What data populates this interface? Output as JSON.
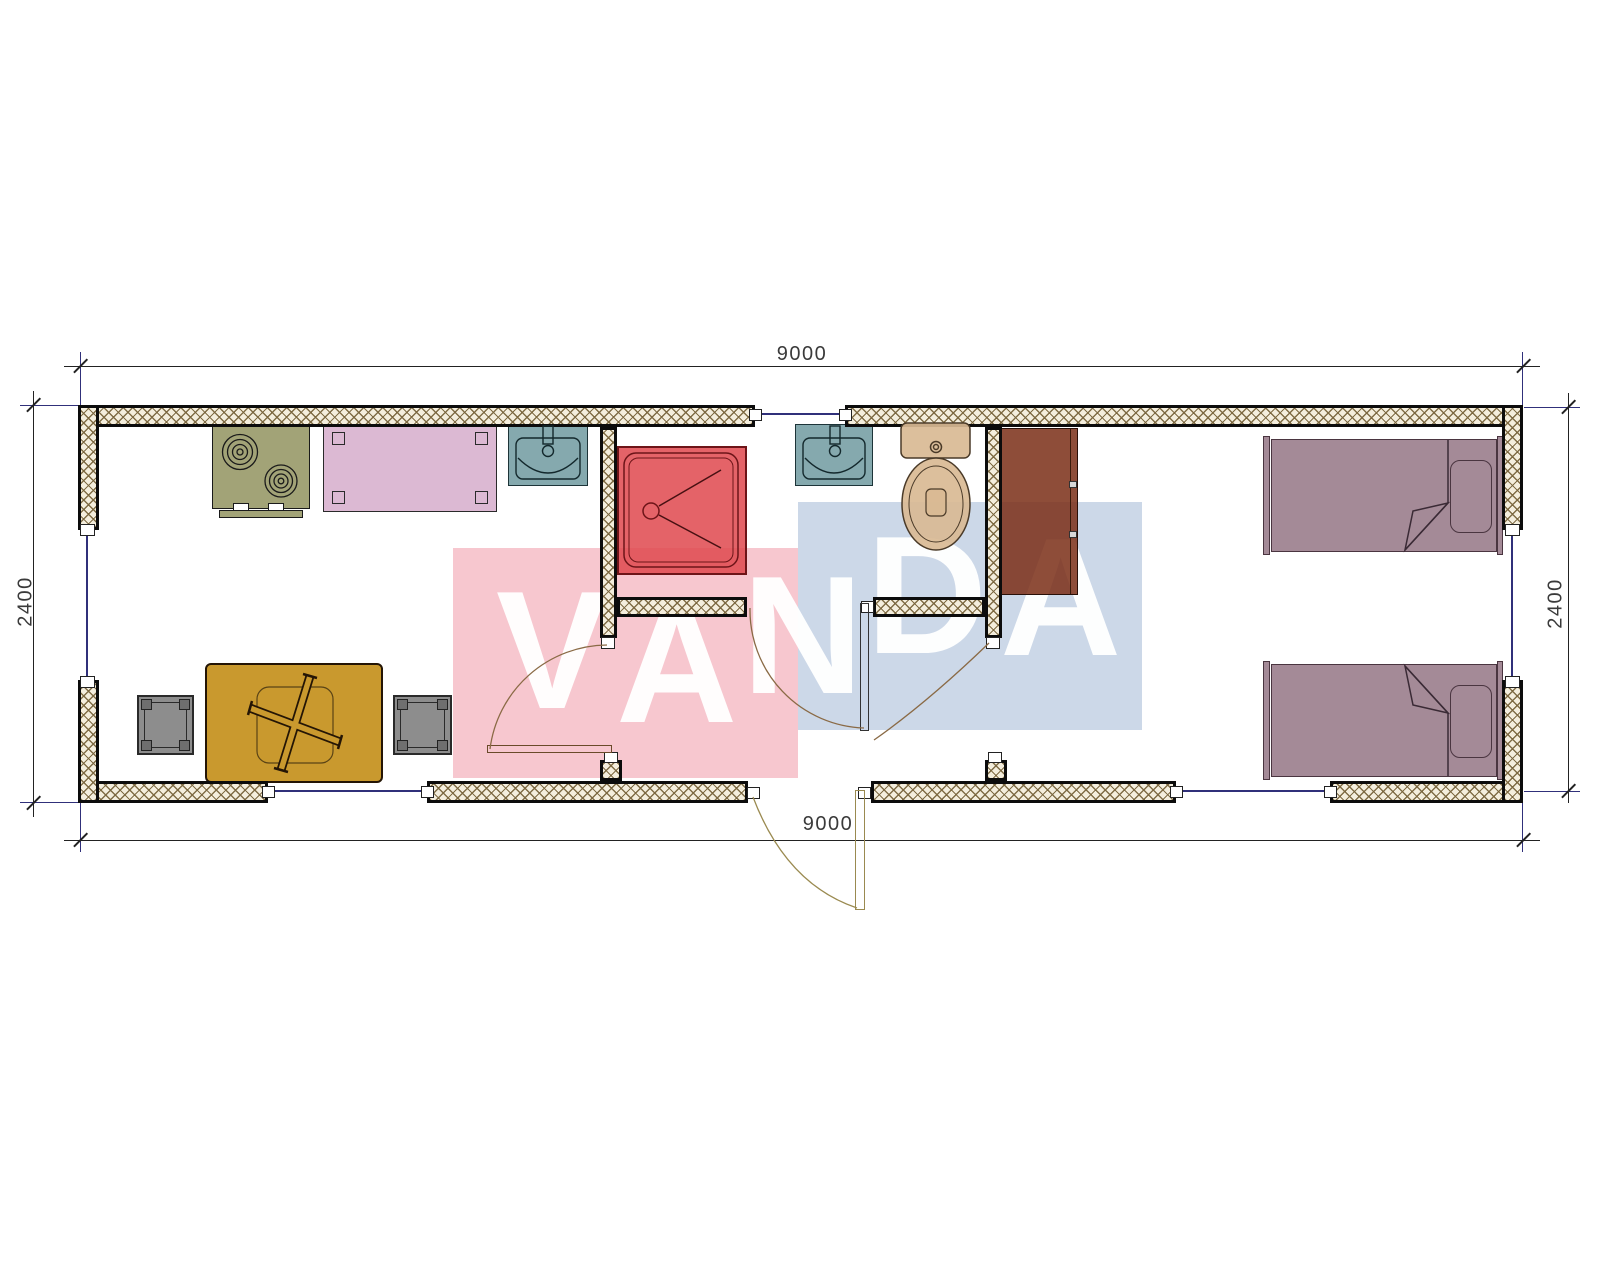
{
  "drawing": {
    "type": "floor-plan",
    "dimensions": {
      "top": "9000",
      "bottom": "9000",
      "left": "2400",
      "right": "2400"
    },
    "watermark": {
      "text": "VANDA",
      "letters": [
        "V",
        "A",
        "N",
        "D",
        "A"
      ]
    },
    "palette": {
      "wall_fill": "#f4eedd",
      "wall_line": "#0c0c0c",
      "hatch": "rgba(122,102,62,0.95)",
      "wm_pink": "#f7c7cf",
      "wm_blue": "#ccd8e8",
      "wm_text": "rgba(255,255,255,0.96)",
      "stove": "#a2a377",
      "table_pink": "#dcb9d3",
      "sink": "#85a9ae",
      "shower": "rgba(223,73,79,0.86)",
      "toilet": "rgba(217,186,148,0.92)",
      "cabinet": "rgba(122,46,22,0.85)",
      "bed": "#a48a97",
      "table_gold": "#c9992e",
      "stool": "#8d8d8d",
      "stool_dark": "#6f6f6f",
      "dim_line": "#222222",
      "dim_text": "#3a3a3a",
      "ext_line": "#30307a",
      "win_line": "#30307a",
      "arc": "#8a6a45",
      "entry_door": "#9a8a50"
    }
  }
}
